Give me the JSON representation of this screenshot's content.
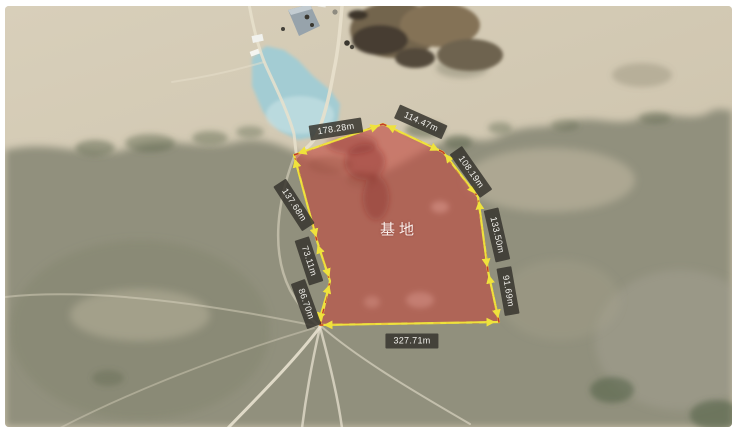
{
  "map": {
    "kind": "satellite",
    "area": {
      "label": "基地",
      "fill_color": "#c04b40",
      "outline_yellow": "#ede23f",
      "outline_red_dash": "#c5392a"
    },
    "measurements": [
      {
        "edge": "top-left",
        "text": "178.28m"
      },
      {
        "edge": "top-right",
        "text": "114.47m"
      },
      {
        "edge": "upper-right",
        "text": "108.19m"
      },
      {
        "edge": "right",
        "text": "133.50m"
      },
      {
        "edge": "lower-right",
        "text": "91.69m"
      },
      {
        "edge": "bottom",
        "text": "327.71m"
      },
      {
        "edge": "lower-left",
        "text": "86.70m"
      },
      {
        "edge": "left-lower",
        "text": "73.11m"
      },
      {
        "edge": "left-upper",
        "text": "137.68m"
      }
    ],
    "label_style": {
      "bg": "#38362e",
      "text_color": "#f2f1ec"
    },
    "terrain_colors": {
      "sand": "#cfc5af",
      "grass": "#91907d",
      "pond": "#a3ccd3",
      "excavation": "#5c5242"
    }
  }
}
